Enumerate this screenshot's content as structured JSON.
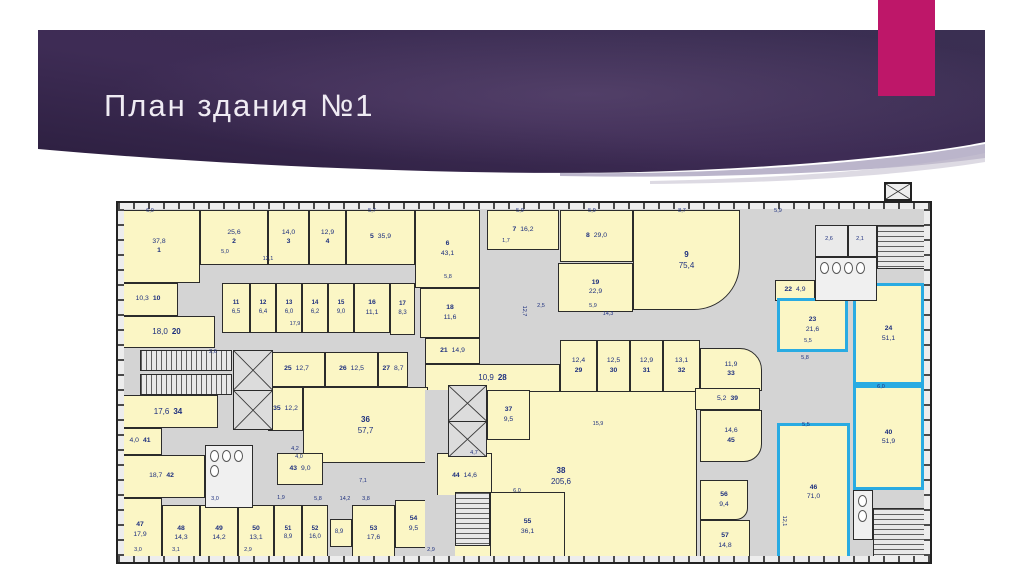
{
  "slide": {
    "title": "План здания №1"
  },
  "colors": {
    "banner_dark": "#2B1E3E",
    "banner_mid": "#3E2C55",
    "banner_light": "#46355C",
    "accent_magenta": "#BE1769",
    "title_text": "#EFEBF3",
    "room_fill": "#FBF6C5",
    "wall": "#2B2B2B",
    "corridor": "#D4D4D4",
    "highlight_blue": "#29ABE2",
    "label_navy": "#1D2F7E"
  },
  "plan": {
    "highlighted_room_numbers": [
      "23",
      "24",
      "40",
      "46"
    ],
    "rooms": [
      {
        "n": "1",
        "a": "37,8",
        "x": 0,
        "y": 7,
        "w": 82,
        "h": 73,
        "o": "a"
      },
      {
        "n": "2",
        "a": "25,6",
        "x": 82,
        "y": 7,
        "w": 68,
        "h": 55,
        "o": "a"
      },
      {
        "n": "3",
        "a": "14,0",
        "x": 150,
        "y": 7,
        "w": 41,
        "h": 55,
        "o": "a"
      },
      {
        "n": "4",
        "a": "12,9",
        "x": 191,
        "y": 7,
        "w": 37,
        "h": 55,
        "o": "a"
      },
      {
        "n": "5",
        "a": "35,9",
        "x": 228,
        "y": 7,
        "w": 69,
        "h": 55,
        "o": "n",
        "inl": 1
      },
      {
        "n": "6",
        "a": "43,1",
        "x": 297,
        "y": 7,
        "w": 65,
        "h": 78,
        "o": "n"
      },
      {
        "n": "7",
        "a": "16,2",
        "x": 369,
        "y": 7,
        "w": 72,
        "h": 40,
        "o": "n",
        "inl": 1
      },
      {
        "n": "8",
        "a": "29,0",
        "x": 442,
        "y": 7,
        "w": 73,
        "h": 52,
        "o": "n",
        "inl": 1
      },
      {
        "n": "9",
        "a": "75,4",
        "x": 515,
        "y": 7,
        "w": 107,
        "h": 100,
        "o": "n",
        "r": "0 0 46px 0"
      },
      {
        "n": "10",
        "a": "10,3",
        "x": 0,
        "y": 80,
        "w": 60,
        "h": 33,
        "o": "a",
        "inl": 1
      },
      {
        "n": "11",
        "a": "6,5",
        "x": 104,
        "y": 80,
        "w": 28,
        "h": 50,
        "o": "n"
      },
      {
        "n": "12",
        "a": "6,4",
        "x": 132,
        "y": 80,
        "w": 26,
        "h": 50,
        "o": "n"
      },
      {
        "n": "13",
        "a": "6,0",
        "x": 158,
        "y": 80,
        "w": 26,
        "h": 50,
        "o": "n"
      },
      {
        "n": "14",
        "a": "6,2",
        "x": 184,
        "y": 80,
        "w": 26,
        "h": 50,
        "o": "n"
      },
      {
        "n": "15",
        "a": "9,0",
        "x": 210,
        "y": 80,
        "w": 26,
        "h": 50,
        "o": "n"
      },
      {
        "n": "16",
        "a": "11,1",
        "x": 236,
        "y": 80,
        "w": 36,
        "h": 50,
        "o": "n"
      },
      {
        "n": "17",
        "a": "8,3",
        "x": 272,
        "y": 80,
        "w": 25,
        "h": 52,
        "o": "n"
      },
      {
        "n": "18",
        "a": "11,6",
        "x": 302,
        "y": 85,
        "w": 60,
        "h": 50,
        "o": "n"
      },
      {
        "n": "19",
        "a": "22,9",
        "x": 440,
        "y": 60,
        "w": 75,
        "h": 49,
        "o": "n"
      },
      {
        "n": "20",
        "a": "18,0",
        "x": 0,
        "y": 113,
        "w": 97,
        "h": 32,
        "o": "a",
        "inl": 1
      },
      {
        "n": "21",
        "a": "14,9",
        "x": 307,
        "y": 135,
        "w": 55,
        "h": 26,
        "o": "n"
      },
      {
        "n": "22",
        "a": "4,9",
        "x": 657,
        "y": 77,
        "w": 40,
        "h": 21,
        "o": "n"
      },
      {
        "n": "23",
        "a": "21,6",
        "x": 659,
        "y": 95,
        "w": 71,
        "h": 54,
        "o": "n",
        "hl": 1
      },
      {
        "n": "24",
        "a": "51,1",
        "x": 735,
        "y": 80,
        "w": 71,
        "h": 102,
        "o": "n",
        "hl": 1
      },
      {
        "n": "25",
        "a": "12,7",
        "x": 150,
        "y": 149,
        "w": 57,
        "h": 35,
        "o": "n"
      },
      {
        "n": "26",
        "a": "12,5",
        "x": 207,
        "y": 149,
        "w": 53,
        "h": 35,
        "o": "n"
      },
      {
        "n": "27",
        "a": "8,7",
        "x": 260,
        "y": 149,
        "w": 30,
        "h": 35,
        "o": "n"
      },
      {
        "n": "28",
        "a": "10,9",
        "x": 307,
        "y": 161,
        "w": 135,
        "h": 28,
        "o": "a"
      },
      {
        "n": "29",
        "a": "12,4",
        "x": 442,
        "y": 137,
        "w": 37,
        "h": 52,
        "o": "a"
      },
      {
        "n": "30",
        "a": "12,5",
        "x": 479,
        "y": 137,
        "w": 33,
        "h": 52,
        "o": "a"
      },
      {
        "n": "31",
        "a": "12,9",
        "x": 512,
        "y": 137,
        "w": 33,
        "h": 52,
        "o": "a"
      },
      {
        "n": "32",
        "a": "13,1",
        "x": 545,
        "y": 137,
        "w": 37,
        "h": 52,
        "o": "a"
      },
      {
        "n": "33",
        "a": "11,9",
        "x": 582,
        "y": 145,
        "w": 62,
        "h": 43,
        "o": "a",
        "r": "0 22px 0 0"
      },
      {
        "n": "34",
        "a": "17,6",
        "x": 0,
        "y": 192,
        "w": 100,
        "h": 33,
        "o": "a",
        "inl": 1
      },
      {
        "n": "35",
        "a": "12,2",
        "x": 150,
        "y": 184,
        "w": 35,
        "h": 44,
        "o": "n",
        "inl": 1
      },
      {
        "n": "36",
        "a": "57,7",
        "x": 185,
        "y": 184,
        "w": 125,
        "h": 76,
        "o": "n"
      },
      {
        "n": "37",
        "a": "9,5",
        "x": 369,
        "y": 187,
        "w": 43,
        "h": 50,
        "o": "n"
      },
      {
        "n": "38",
        "a": "205,6",
        "x": 307,
        "y": 187,
        "w": 272,
        "h": 172,
        "o": "n"
      },
      {
        "n": "39",
        "a": "5,2",
        "x": 577,
        "y": 185,
        "w": 65,
        "h": 22,
        "o": "a"
      },
      {
        "n": "40",
        "a": "51,9",
        "x": 735,
        "y": 182,
        "w": 71,
        "h": 105,
        "o": "n",
        "hl": 1
      },
      {
        "n": "41",
        "a": "4,0",
        "x": 0,
        "y": 225,
        "w": 44,
        "h": 27,
        "o": "a",
        "inl": 1
      },
      {
        "n": "42",
        "a": "18,7",
        "x": 0,
        "y": 252,
        "w": 87,
        "h": 43,
        "o": "a",
        "inl": 1
      },
      {
        "n": "43",
        "a": "9,0",
        "x": 159,
        "y": 250,
        "w": 46,
        "h": 32,
        "o": "n"
      },
      {
        "n": "44",
        "a": "14,6",
        "x": 319,
        "y": 250,
        "w": 55,
        "h": 47,
        "o": "n",
        "inl": 1
      },
      {
        "n": "45",
        "a": "14,6",
        "x": 582,
        "y": 207,
        "w": 62,
        "h": 52,
        "o": "a",
        "r": "0 0 18px 0"
      },
      {
        "n": "46",
        "a": "71,0",
        "x": 659,
        "y": 220,
        "w": 73,
        "h": 139,
        "o": "n",
        "hl": 1
      },
      {
        "n": "47",
        "a": "17,9",
        "x": 0,
        "y": 295,
        "w": 44,
        "h": 64,
        "o": "n"
      },
      {
        "n": "48",
        "a": "14,3",
        "x": 44,
        "y": 302,
        "w": 38,
        "h": 57,
        "o": "n"
      },
      {
        "n": "49",
        "a": "14,2",
        "x": 82,
        "y": 302,
        "w": 38,
        "h": 57,
        "o": "n"
      },
      {
        "n": "50",
        "a": "13,1",
        "x": 120,
        "y": 302,
        "w": 36,
        "h": 57,
        "o": "n"
      },
      {
        "n": "51",
        "a": "8,9",
        "x": 156,
        "y": 302,
        "w": 28,
        "h": 57,
        "o": "n"
      },
      {
        "n": "52",
        "a": "16,0",
        "x": 184,
        "y": 302,
        "w": 26,
        "h": 57,
        "o": "n"
      },
      {
        "n": "",
        "a": "8,9",
        "x": 212,
        "y": 316,
        "w": 22,
        "h": 28,
        "o": "a"
      },
      {
        "n": "53",
        "a": "17,6",
        "x": 234,
        "y": 302,
        "w": 43,
        "h": 57,
        "o": "n"
      },
      {
        "n": "54",
        "a": "9,5",
        "x": 277,
        "y": 297,
        "w": 37,
        "h": 48,
        "o": "n"
      },
      {
        "n": "55",
        "a": "36,1",
        "x": 372,
        "y": 289,
        "w": 75,
        "h": 70,
        "o": "n"
      },
      {
        "n": "56",
        "a": "9,4",
        "x": 582,
        "y": 277,
        "w": 48,
        "h": 40,
        "o": "n",
        "r": "0 0 12px 0"
      },
      {
        "n": "57",
        "a": "14,8",
        "x": 582,
        "y": 317,
        "w": 50,
        "h": 42,
        "o": "n"
      }
    ],
    "dims": [
      {
        "t": "6,0",
        "x": 32,
        "y": 8
      },
      {
        "t": "5,7",
        "x": 254,
        "y": 8
      },
      {
        "t": "5,9",
        "x": 402,
        "y": 8
      },
      {
        "t": "5,9",
        "x": 474,
        "y": 8
      },
      {
        "t": "8,7",
        "x": 564,
        "y": 8
      },
      {
        "t": "5,9",
        "x": 660,
        "y": 8
      },
      {
        "t": "12,1",
        "x": 150,
        "y": 56
      },
      {
        "t": "5,0",
        "x": 107,
        "y": 49
      },
      {
        "t": "5,8",
        "x": 330,
        "y": 74
      },
      {
        "t": "1,7",
        "x": 388,
        "y": 38
      },
      {
        "t": "17,9",
        "x": 177,
        "y": 121
      },
      {
        "t": "2,6",
        "x": 95,
        "y": 149
      },
      {
        "t": "2,5",
        "x": 423,
        "y": 103
      },
      {
        "t": "5,9",
        "x": 475,
        "y": 103
      },
      {
        "t": "14,3",
        "x": 490,
        "y": 111
      },
      {
        "t": "15,9",
        "x": 480,
        "y": 221
      },
      {
        "t": "12,7",
        "x": 406,
        "y": 108,
        "v": 1
      },
      {
        "t": "2,6",
        "x": 711,
        "y": 36
      },
      {
        "t": "2,1",
        "x": 742,
        "y": 36
      },
      {
        "t": "4,2",
        "x": 177,
        "y": 246
      },
      {
        "t": "4,0",
        "x": 181,
        "y": 254
      },
      {
        "t": "4,7",
        "x": 356,
        "y": 250
      },
      {
        "t": "6,0",
        "x": 399,
        "y": 288
      },
      {
        "t": "7,1",
        "x": 245,
        "y": 278
      },
      {
        "t": "14,2",
        "x": 227,
        "y": 296
      },
      {
        "t": "3,0",
        "x": 97,
        "y": 296
      },
      {
        "t": "1,9",
        "x": 163,
        "y": 295
      },
      {
        "t": "5,8",
        "x": 200,
        "y": 296
      },
      {
        "t": "3,8",
        "x": 248,
        "y": 296
      },
      {
        "t": "3,0",
        "x": 20,
        "y": 347
      },
      {
        "t": "3,1",
        "x": 58,
        "y": 347
      },
      {
        "t": "2,9",
        "x": 130,
        "y": 347
      },
      {
        "t": "2,9",
        "x": 313,
        "y": 347
      },
      {
        "t": "5,5",
        "x": 690,
        "y": 138
      },
      {
        "t": "5,8",
        "x": 687,
        "y": 155
      },
      {
        "t": "5,5",
        "x": 688,
        "y": 222
      },
      {
        "t": "6,0",
        "x": 763,
        "y": 184
      },
      {
        "t": "12,1",
        "x": 666,
        "y": 318,
        "v": 1
      }
    ],
    "features": [
      {
        "t": "patch",
        "x": 307,
        "y": 187,
        "w": 23,
        "h": 63,
        "name": "corridor-patch"
      },
      {
        "t": "patch",
        "x": 307,
        "y": 250,
        "w": 12,
        "h": 109,
        "name": "corridor-patch"
      },
      {
        "t": "patch",
        "x": 314,
        "y": 292,
        "w": 23,
        "h": 67,
        "name": "corridor-patch"
      },
      {
        "t": "sv",
        "x": 22,
        "y": 147,
        "w": 92,
        "h": 21,
        "name": "staircase-west-upper"
      },
      {
        "t": "sv",
        "x": 22,
        "y": 171,
        "w": 92,
        "h": 21,
        "name": "staircase-west-lower"
      },
      {
        "t": "sh",
        "x": 337,
        "y": 289,
        "w": 35,
        "h": 54,
        "name": "staircase-central"
      },
      {
        "t": "sh",
        "x": 755,
        "y": 305,
        "w": 55,
        "h": 54,
        "name": "staircase-southeast"
      },
      {
        "t": "sh",
        "x": 759,
        "y": 22,
        "w": 49,
        "h": 44,
        "name": "staircase-northeast"
      },
      {
        "t": "elev",
        "x": 115,
        "y": 147,
        "w": 40,
        "h": 80,
        "name": "elevator-west"
      },
      {
        "t": "elev",
        "x": 330,
        "y": 182,
        "w": 39,
        "h": 72,
        "name": "elevator-central"
      },
      {
        "t": "wc",
        "x": 87,
        "y": 242,
        "w": 48,
        "h": 63,
        "fix": 4,
        "mode": "grid",
        "name": "wc-central"
      },
      {
        "t": "wc",
        "x": 697,
        "y": 54,
        "w": 62,
        "h": 44,
        "fix": 4,
        "mode": "row",
        "name": "wc-northeast"
      },
      {
        "t": "wc",
        "x": 735,
        "y": 287,
        "w": 20,
        "h": 50,
        "fix": 2,
        "mode": "col",
        "name": "wc-southeast"
      },
      {
        "t": "box",
        "x": 697,
        "y": 22,
        "w": 33,
        "h": 32,
        "name": "utility-room"
      },
      {
        "t": "box",
        "x": 730,
        "y": 22,
        "w": 29,
        "h": 32,
        "name": "utility-room"
      },
      {
        "t": "elevx",
        "page": 1,
        "x": 884,
        "y": 182,
        "w": 28,
        "h": 19,
        "name": "roof-shaft"
      }
    ]
  }
}
